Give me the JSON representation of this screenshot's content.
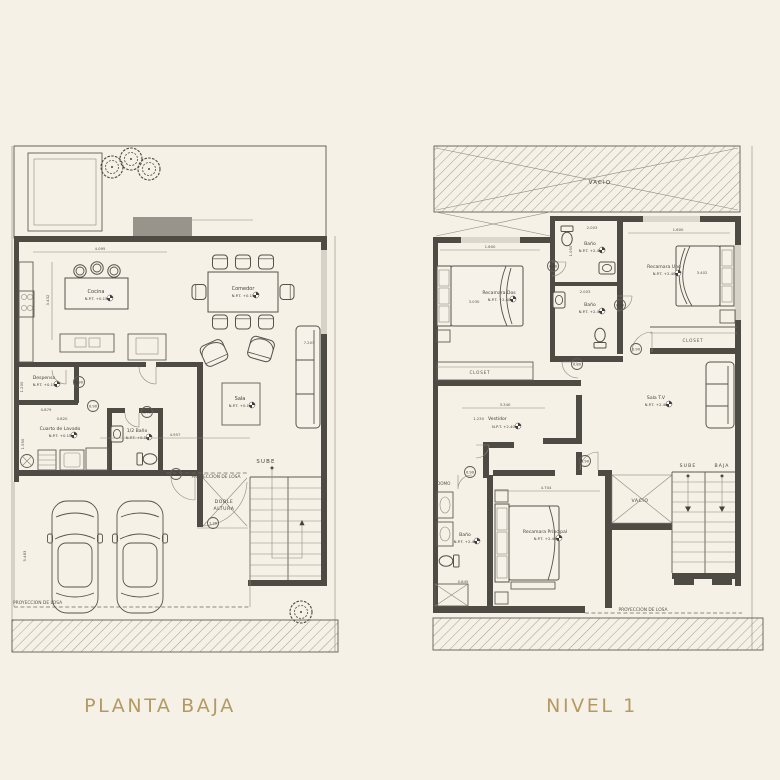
{
  "colors": {
    "background": "#f5f1e7",
    "wall": "#4e4b45",
    "accent_title": "#b49a62",
    "hatch_line": "#a49e90",
    "gray_block": "#98948b"
  },
  "titles": {
    "planta_baja": "PLANTA BAJA",
    "nivel_1": "NIVEL 1"
  },
  "planta_baja": {
    "rooms": {
      "cocina": {
        "label": "Cocina",
        "npt": "N.P.T. +0.15"
      },
      "comedor": {
        "label": "Comedor",
        "npt": "N.P.T. +0.15"
      },
      "sala": {
        "label": "Sala",
        "npt": "N.P.T. +0.15"
      },
      "despensa": {
        "label": "Despensa",
        "npt": "N.P.T. +0.15"
      },
      "cuarto_lavado": {
        "label": "Cuarto de Lavado",
        "npt": "N.P.T. +0.15"
      },
      "medio_bano": {
        "label": "1/2 Baño",
        "npt": "N.P.T. +0.15"
      }
    },
    "annotations": {
      "sube": "SUBE",
      "doble_altura_line1": "DOBLE",
      "doble_altura_line2": "ALTURA",
      "proyeccion_losa_interior": "PROYECCION DE LOSA",
      "proyeccion_losa_exterior": "PROYECCION DE LOSA"
    },
    "dimensions": {
      "cocina_ancho": "4.095",
      "cocina_alto": "3.432",
      "sala_alto": "7.203",
      "sala_ancho": "4.957",
      "lavado_ancho": "0.820",
      "despensa_alto": "1.200",
      "despensa_ancho": "0.879",
      "lavado_alto": "1.550",
      "cochera_alto": "5.483"
    },
    "door_tags": [
      "0.90",
      "0.90",
      "0.70",
      "0.92",
      "1.30"
    ]
  },
  "nivel_1": {
    "rooms": {
      "recamara_dos": {
        "label": "Recamara Dos",
        "npt": "N.P.T. +2.40"
      },
      "recamara_uno": {
        "label": "Recamara Uno",
        "npt": "N.P.T. +2.40"
      },
      "recamara_principal": {
        "label": "Recamara Principal",
        "npt": "N.P.T. +2.40"
      },
      "bano_uno": {
        "label": "Baño",
        "npt": "N.P.T. +2.40"
      },
      "bano_dos": {
        "label": "Baño",
        "npt": "N.P.T. +2.40"
      },
      "bano_principal": {
        "label": "Baño",
        "npt": "N.P.T. +2.40"
      },
      "sala_tv": {
        "label": "Sala T.V",
        "npt": "N.P.T. +2.40"
      },
      "vestidor": {
        "label": "Vestidor",
        "npt": "N.P.T. +2.40"
      }
    },
    "annotations": {
      "vacio_azotea": "VACIO",
      "vacio_escalera": "VACIO",
      "closet_izq": "CLOSET",
      "closet_der": "CLOSET",
      "domo": "DOMO",
      "sube": "SUBE",
      "baja": "BAJA",
      "proyeccion_losa": "PROYECCION DE LOSA"
    },
    "dimensions": {
      "rec2_ancho": "1.600",
      "rec2_alto": "3.030",
      "bano1_ancho": "2.003",
      "bano1_alto": "1.050",
      "rec1_ancho": "1.600",
      "rec1_alto": "3.402",
      "bano2_ancho": "2.003",
      "vestidor_ancho": "3.340",
      "vestidor_alto": "1.230",
      "recppal_ancho": "4.704",
      "bano_ppal_ancho": "0.845"
    },
    "door_tags": [
      "0.60",
      "0.60",
      "0.90",
      "0.80",
      "0.90",
      "0.90"
    ]
  }
}
